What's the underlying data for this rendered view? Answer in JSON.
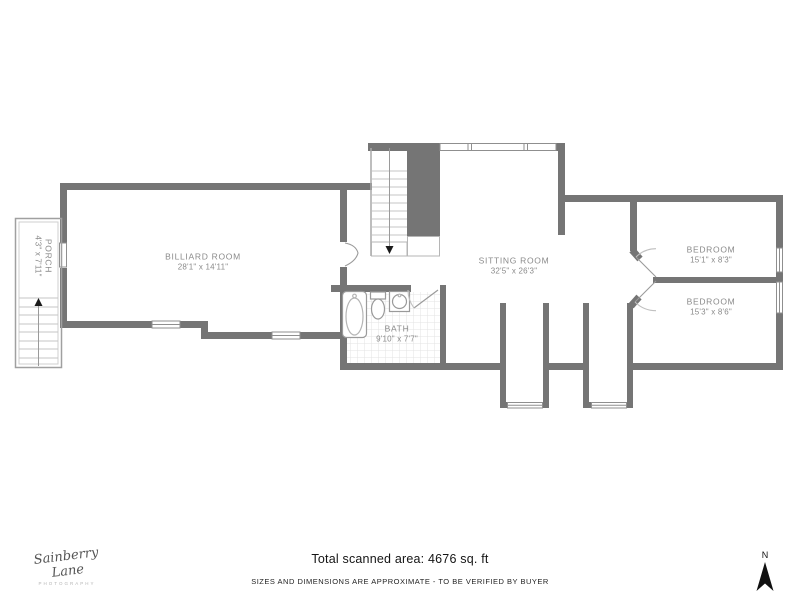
{
  "plan": {
    "rooms": {
      "billiard": {
        "name": "BILLIARD ROOM",
        "dims": "28'1\" x 14'11\""
      },
      "sitting": {
        "name": "SITTING ROOM",
        "dims": "32'5\" x 26'3\""
      },
      "bath": {
        "name": "BATH",
        "dims": "9'10\" x 7'7\""
      },
      "bedroom_top": {
        "name": "BEDROOM",
        "dims": "15'1\" x 8'3\""
      },
      "bedroom_bottom": {
        "name": "BEDROOM",
        "dims": "15'3\" x 8'6\""
      },
      "porch": {
        "name": "PORCH",
        "dims": "4'3\" x 7'11\""
      }
    }
  },
  "footer": {
    "total_area": "Total scanned area: 4676 sq. ft",
    "disclaimer": "SIZES AND DIMENSIONS ARE APPROXIMATE - TO BE VERIFIED BY BUYER"
  },
  "branding": {
    "name_script": "Sainberry Lane",
    "subtitle": "PHOTOGRAPHY"
  },
  "compass": {
    "north_label": "N"
  },
  "colors": {
    "wall": "#757575",
    "thin_line": "#9a9a9a",
    "label_text": "#8a8a8a",
    "footer_text": "#141414",
    "tile_line": "#e3e3e3"
  }
}
